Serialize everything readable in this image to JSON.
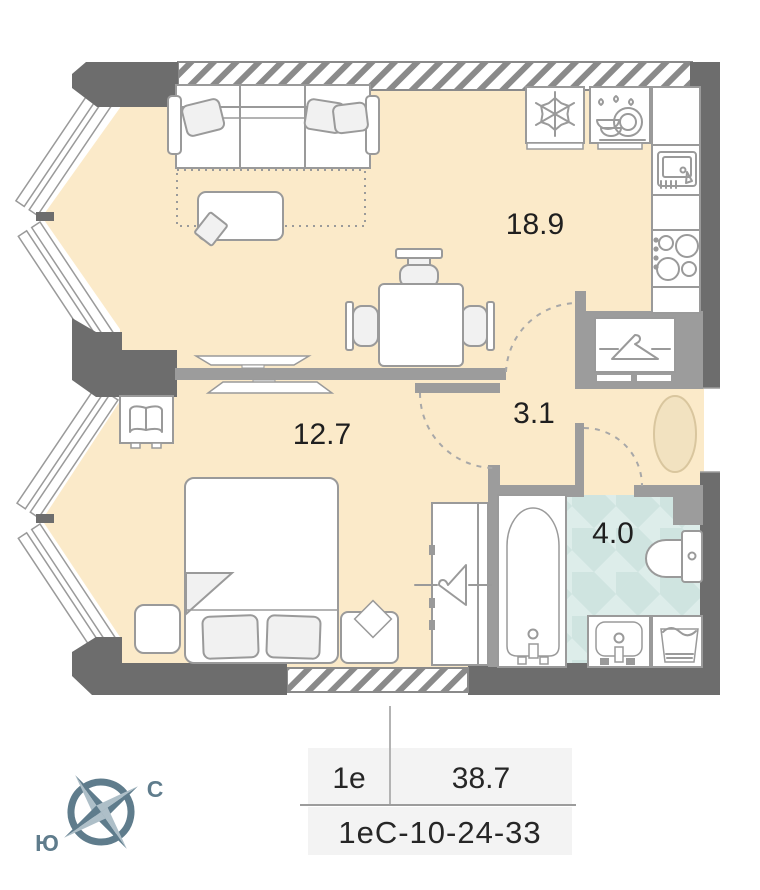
{
  "plan_title": "apartment-floor-plan",
  "rooms": [
    {
      "name": "living-kitchen",
      "area": "18.9"
    },
    {
      "name": "bedroom",
      "area": "12.7"
    },
    {
      "name": "hallway",
      "area": "3.1"
    },
    {
      "name": "bathroom",
      "area": "4.0"
    }
  ],
  "compass": {
    "north": "С",
    "south": "Ю"
  },
  "info_table": {
    "plan_type": "1е",
    "total_area": "38.7",
    "apartment_code": "1еС-10-24-33"
  },
  "colors": {
    "floor": "#fbeac9",
    "wall_dark": "#6d6d6d",
    "wall_mid": "#9c9c9c",
    "furniture_outline": "#9a9a9a",
    "bath_tile_light": "#ddedea",
    "bath_tile_dark": "#cfe4e0",
    "entry_rug": "#f2e2c0",
    "compass_dark": "#5f7c8c",
    "compass_light": "#aebfc8",
    "table_bg": "#f3f3f3",
    "label_text": "#1f1f1f"
  }
}
